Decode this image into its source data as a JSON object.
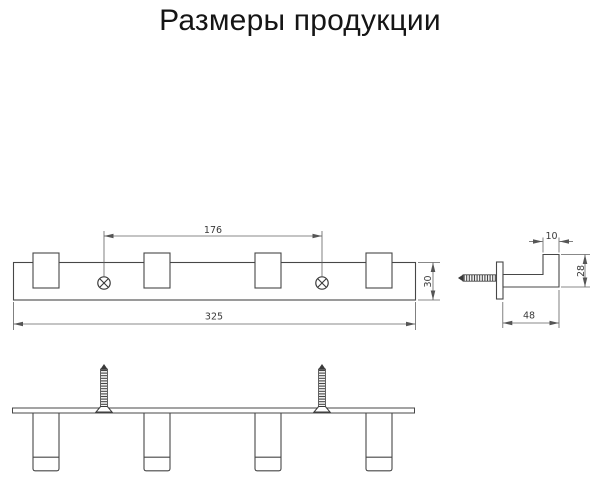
{
  "title": "Размеры продукции",
  "views": {
    "front": {
      "dim_hole_spacing": "176",
      "dim_total_length": "325",
      "dim_rail_height": "30"
    },
    "side": {
      "dim_tip_width": "10",
      "dim_hook_height": "28",
      "dim_hook_depth": "48"
    }
  },
  "colors": {
    "outline": "#474747",
    "dimension_line": "#606060",
    "dimension_text": "#3a3a3a",
    "background": "#ffffff"
  }
}
